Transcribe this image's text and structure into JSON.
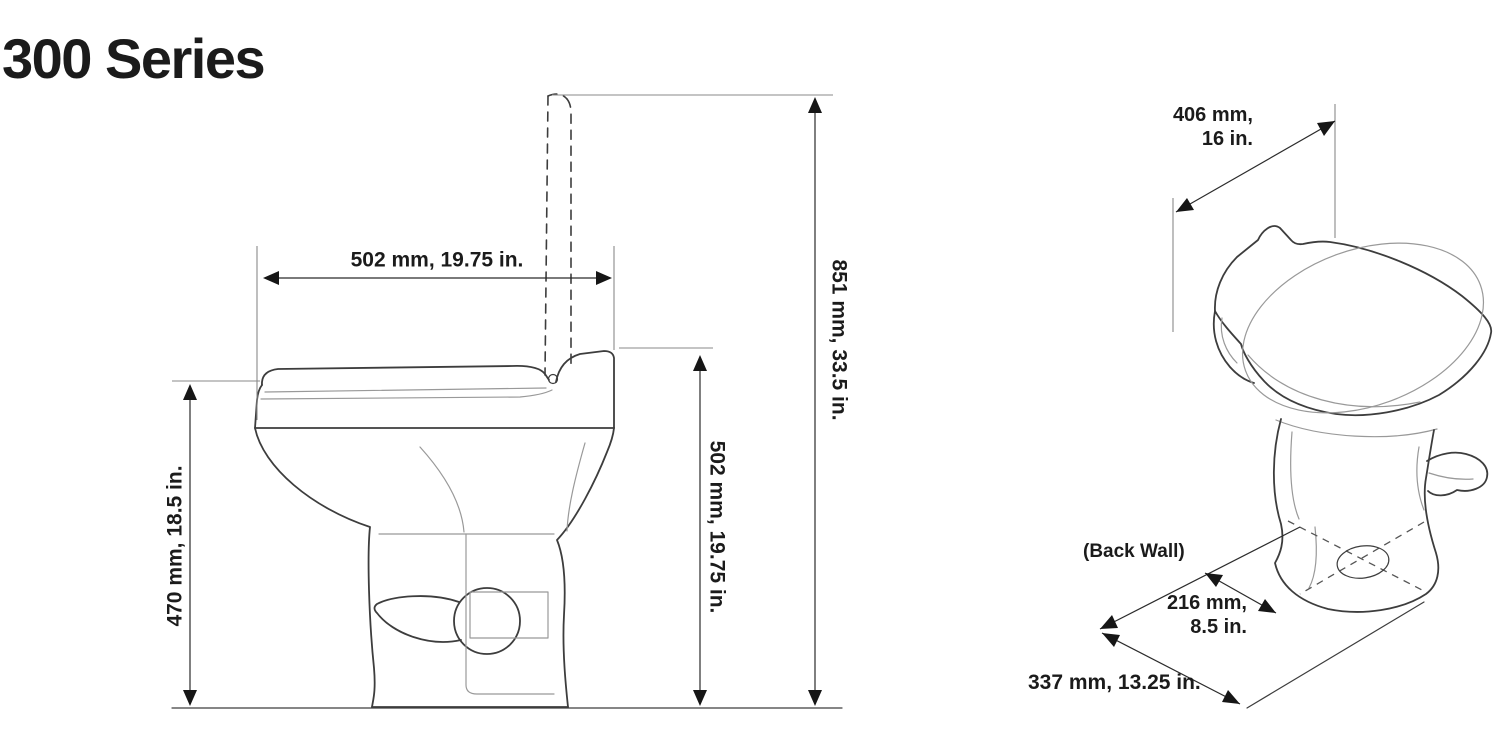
{
  "title": "300 Series",
  "side_view": {
    "dims": {
      "seat_depth": "502 mm, 19.75 in.",
      "bowl_height": "470 mm, 18.5 in.",
      "seat_back_height": "502 mm, 19.75 in.",
      "overall_height_lid_up": "851 mm, 33.5 in."
    }
  },
  "perspective_view": {
    "dims": {
      "width_line1": "406 mm,",
      "width_line2": "16 in.",
      "back_wall_label": "(Back Wall)",
      "drain_offset_line1": "216 mm,",
      "drain_offset_line2": "8.5 in.",
      "base_depth": "337 mm, 13.25 in."
    }
  },
  "colors": {
    "background": "#ffffff",
    "text": "#1b1b1b",
    "outline": "#3d3d3d",
    "secondary": "#999999",
    "dimension": "#2b2b2b",
    "arrow": "#161616"
  }
}
